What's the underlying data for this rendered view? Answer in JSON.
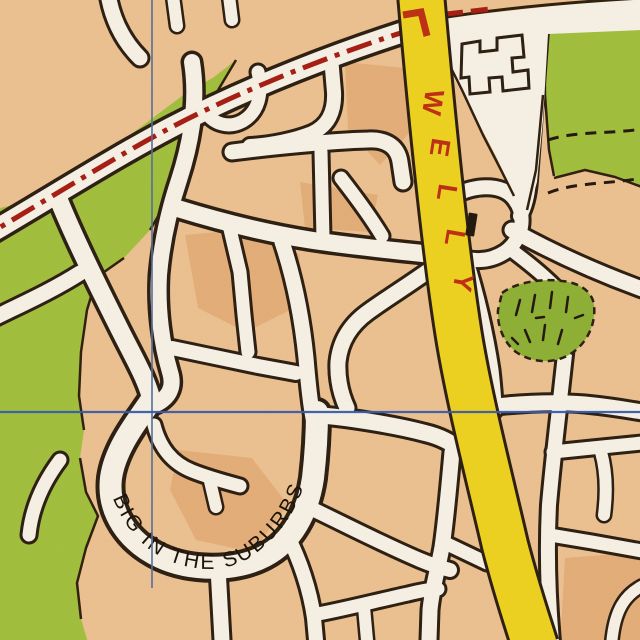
{
  "map": {
    "labels": {
      "welly": {
        "text": "WELLY",
        "letters": [
          "W",
          "E",
          "L",
          "L",
          "Y"
        ],
        "color": "#bf3115"
      },
      "suburbs": {
        "text": "BIG IN THE SUBURBS",
        "color": "#1d150c"
      }
    },
    "colors": {
      "background_orange": "#eec393",
      "dark_tan_patch": "#d99a5d",
      "road_fill": "#f8f3e8",
      "road_casing": "#2e2013",
      "park_green": "#a3c13f",
      "scrub_green": "#90b237",
      "major_road_yellow": "#efd421",
      "boundary_red": "#a81f14",
      "label_red": "#bf3115",
      "grid_blue": "#3a5cae"
    },
    "grid": {
      "vertical_x": 152,
      "horizontal_y": 412
    },
    "features": [
      "residential-street-maze",
      "parkland",
      "boundary-dash-dot-line",
      "major-yellow-road",
      "scrub-patch-hatched",
      "building-outline",
      "footpath-dashed-lines",
      "grid-lines"
    ]
  }
}
